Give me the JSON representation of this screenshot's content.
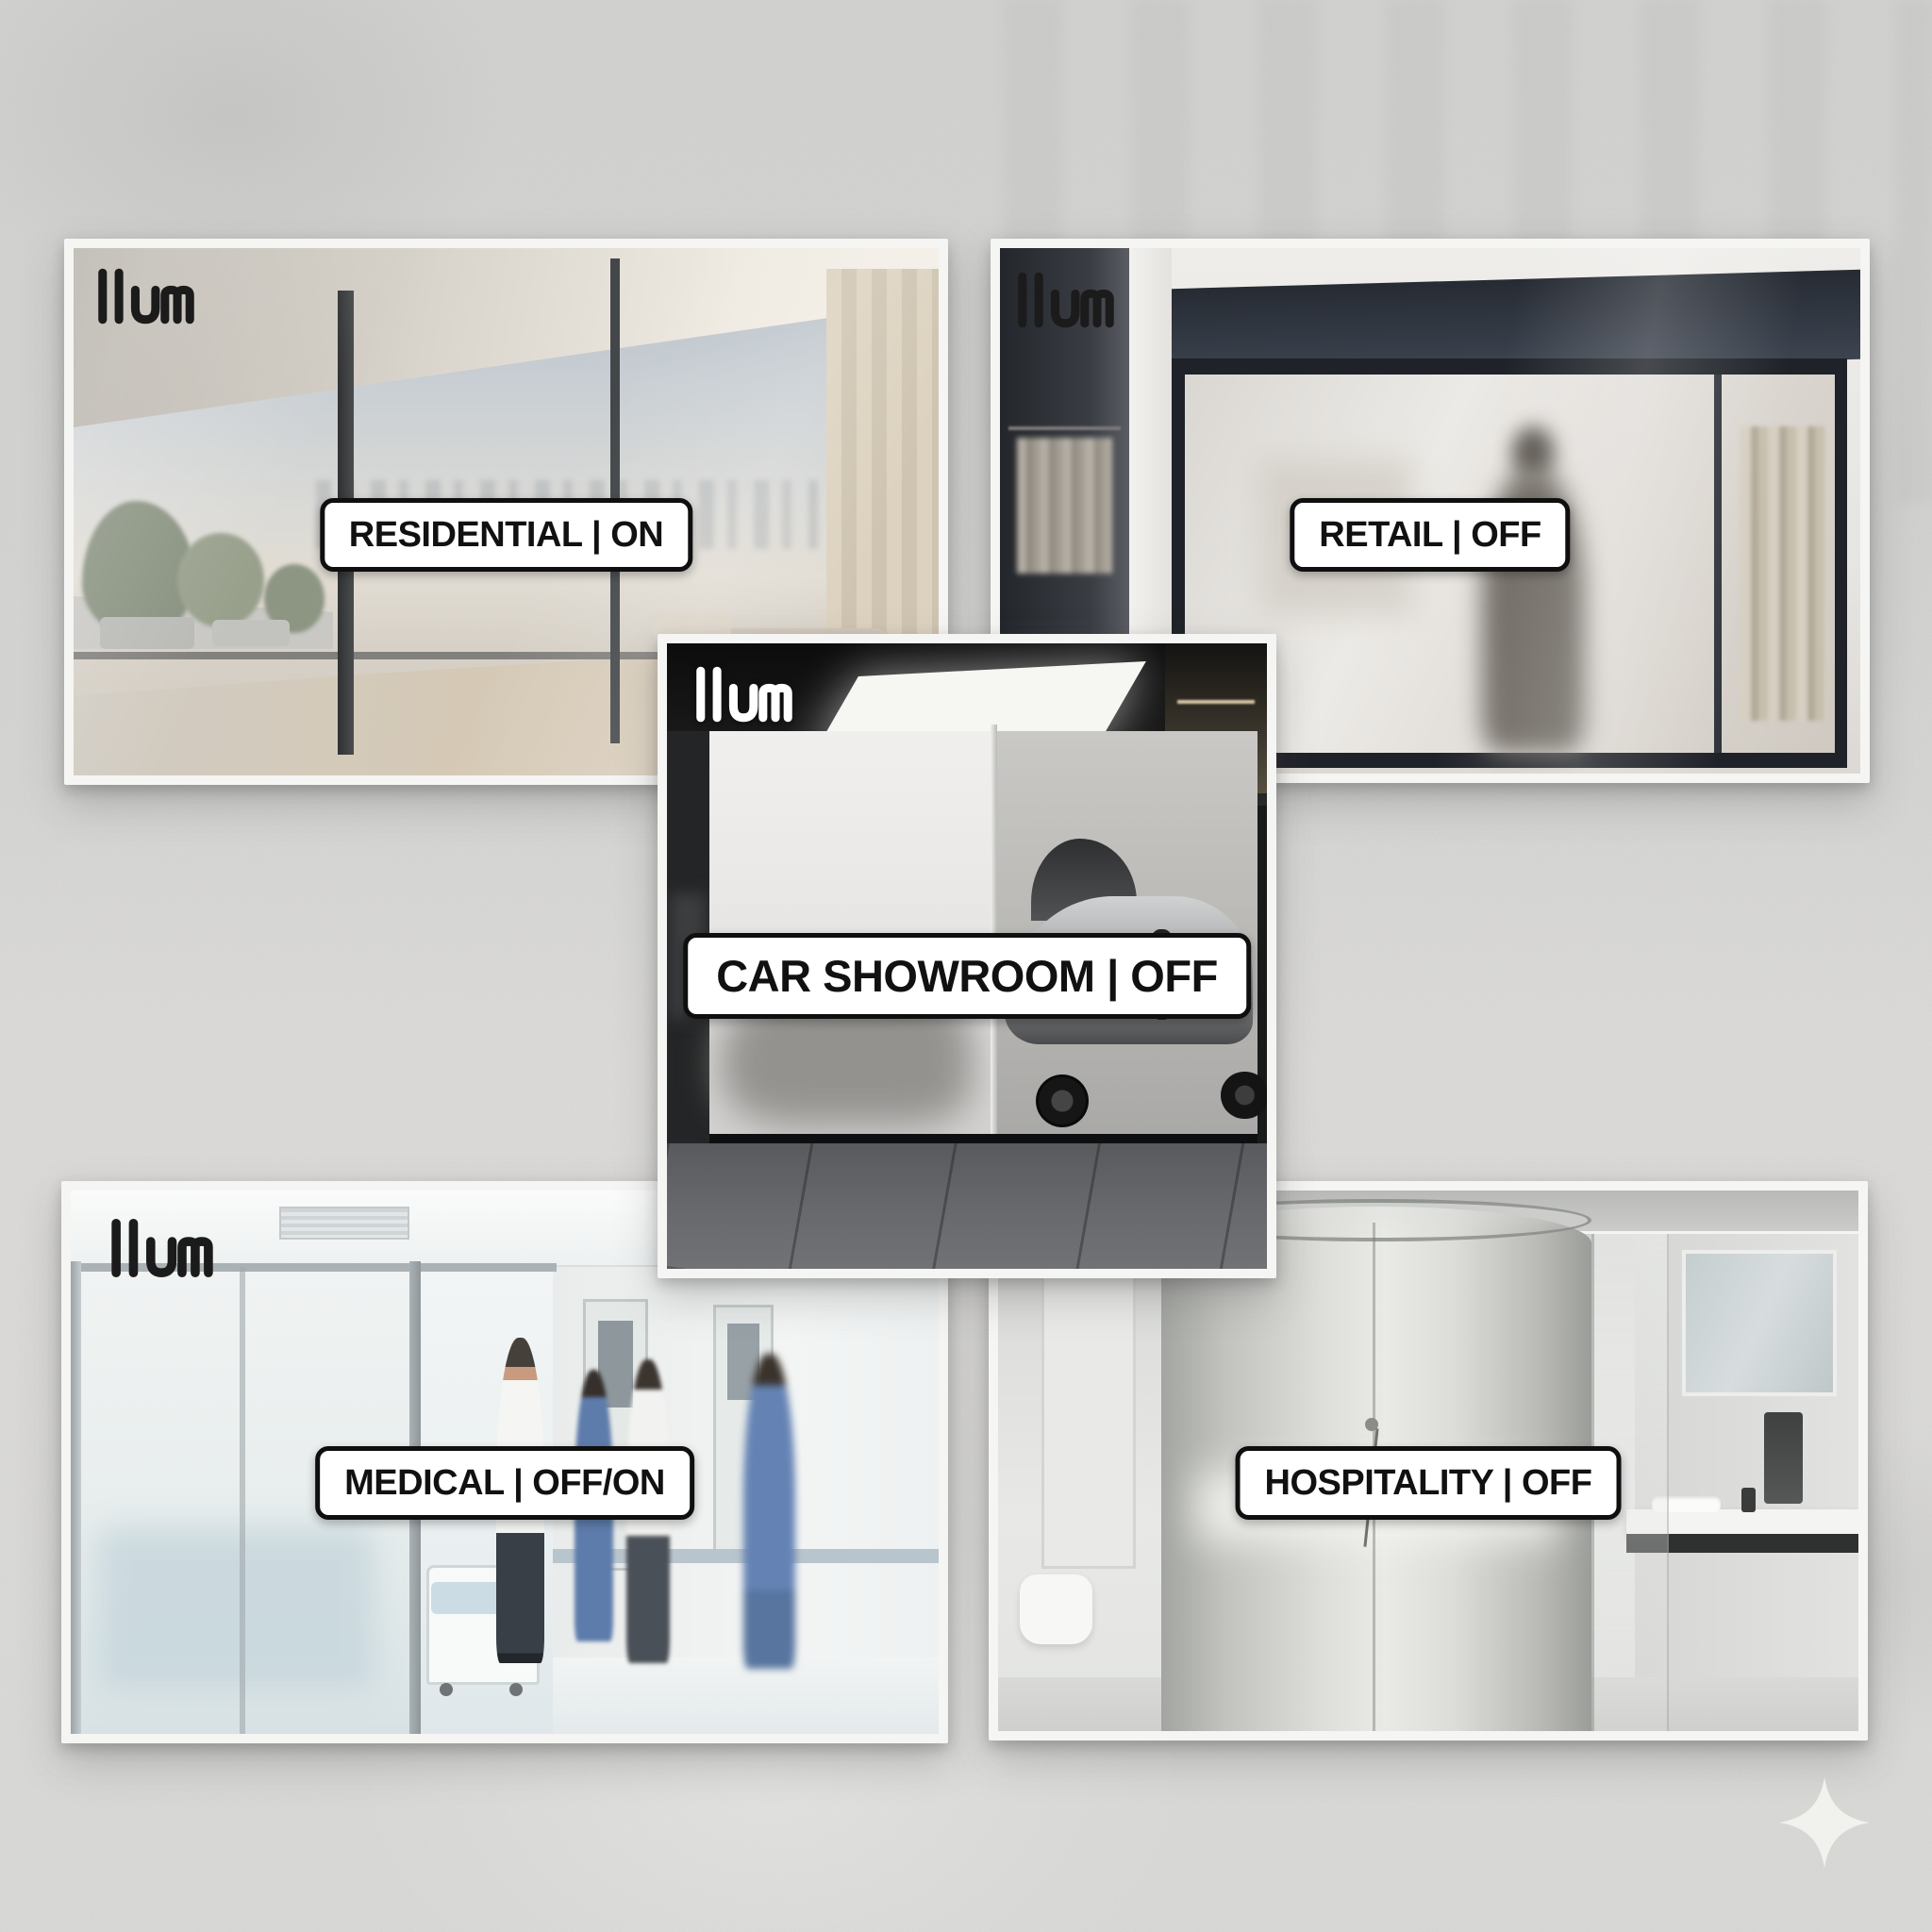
{
  "poster": {
    "brand_logo_text": "llum",
    "cards": [
      {
        "id": "residential",
        "label": "RESIDENTIAL | ON",
        "logo_variant": "dark",
        "scene": "bedroom with clear floor-to-ceiling smart glass, terrace plants and hazy city skyline"
      },
      {
        "id": "retail",
        "label": "RETAIL | OFF",
        "logo_variant": "dark",
        "scene": "storefront with frosted smart glass window and blurred shopper silhouette"
      },
      {
        "id": "car-showroom",
        "label": "CAR SHOWROOM | OFF",
        "logo_variant": "light",
        "scene": "glass corner cube with frosted panel hiding a silver sports car"
      },
      {
        "id": "medical",
        "label": "MEDICAL | OFF/ON",
        "logo_variant": "dark",
        "scene": "hospital room with frosted-to-clear partition, doctor and nurses in corridor"
      },
      {
        "id": "hospitality",
        "label": "HOSPITALITY | OFF",
        "logo_variant": "none",
        "scene": "bathroom with cylindrical frosted glass shower enclosure"
      }
    ],
    "watermark_icon": "four-point-sparkle",
    "colors": {
      "background_concrete": "#d7d7d5",
      "card_frame": "#f5f5f3",
      "label_background": "#ffffff",
      "label_border": "#0f0f0f",
      "label_text": "#111111",
      "logo_dark": "#1b1b1b",
      "logo_light": "#ffffff",
      "sparkle": "#f3f3f0"
    }
  }
}
